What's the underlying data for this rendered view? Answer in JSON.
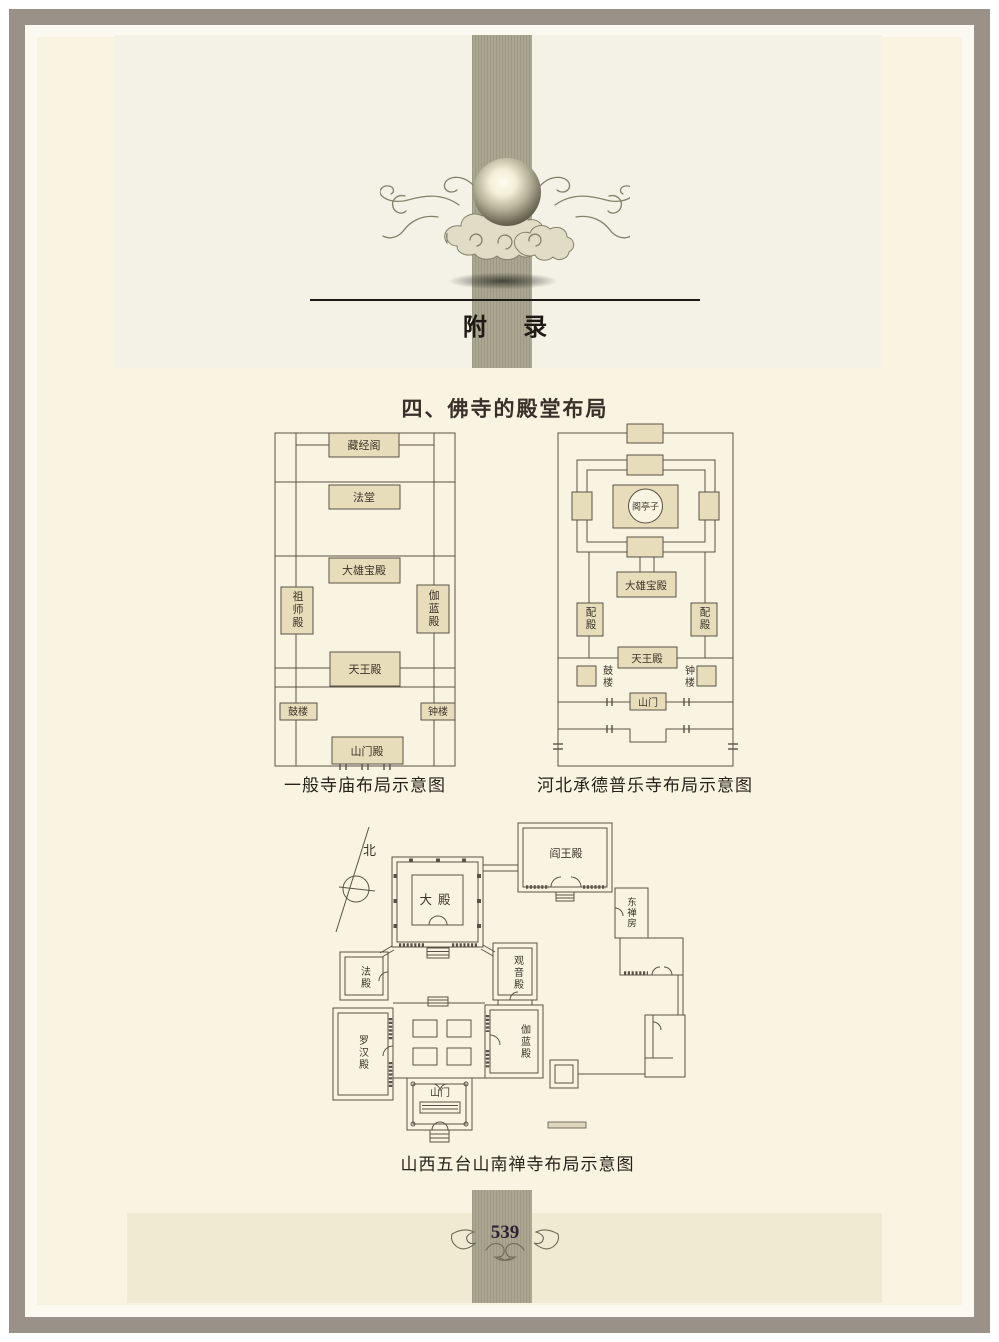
{
  "page": {
    "appendix_title": "附  录",
    "section_heading": "四、佛寺的殿堂布局",
    "page_number": "539"
  },
  "colors": {
    "page_bg": "#f9f4e1",
    "header_bg": "#f4f1e6",
    "footer_bg": "#f1ead3",
    "band": "#a5a18b",
    "frame": "#9a9189",
    "building_fill": "#e8ddbb",
    "line": "#5a5248",
    "ink": "#3c342a"
  },
  "icons": {
    "pearl_ornament": "pearl-and-cloud-ornament",
    "page_number_flourish": "page-number-flourish",
    "compass": "north-compass"
  },
  "diagram_general": {
    "caption": "一般寺庙布局示意图",
    "labels": {
      "cangjingge": "藏经阁",
      "fatang": "法堂",
      "daxiongbaodian": "大雄宝殿",
      "zushidian": "祖师殿",
      "qielandian": "伽蓝殿",
      "tianwangdian": "天王殿",
      "gulou": "鼓楼",
      "zhonglou": "钟楼",
      "shanmendian": "山门殿"
    }
  },
  "diagram_pule": {
    "caption": "河北承德普乐寺布局示意图",
    "labels": {
      "getingzi": "阁亭子",
      "daxiongbaodian": "大雄宝殿",
      "peidian_left": "配殿",
      "peidian_right": "配殿",
      "tianwangdian": "天王殿",
      "gulou": "鼓楼",
      "zhonglou": "钟楼",
      "shanmen": "山门"
    }
  },
  "diagram_nanchan": {
    "caption": "山西五台山南禅寺布局示意图",
    "labels": {
      "north": "北",
      "dadian": "大殿",
      "yanwangdian": "阎王殿",
      "dongchanfang": "东禅房",
      "fadian": "法殿",
      "guanyindian": "观音殿",
      "luohandian": "罗汉殿",
      "qielandian": "伽蓝殿",
      "shanmen": "山门"
    }
  }
}
